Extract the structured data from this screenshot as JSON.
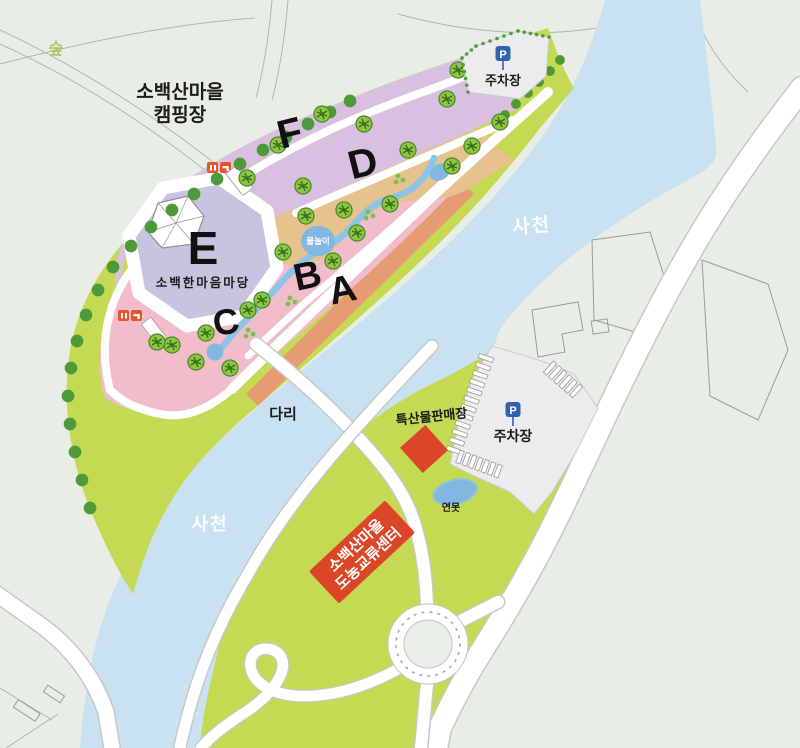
{
  "labels": {
    "forest": "숲",
    "campground_line1": "소백산마을",
    "campground_line2": "캠핑장",
    "river": "사천",
    "bridge": "다리",
    "plaza": "소백한마음마당",
    "water_play": "물놀이",
    "pond": "연못",
    "specialty_shop": "특산물판매장",
    "exchange_center_line1": "소백산마을",
    "exchange_center_line2": "도농교류센터",
    "parking": "주차장",
    "parking_sign": "P"
  },
  "zones": {
    "a": "A",
    "b": "B",
    "c": "C",
    "d": "D",
    "e": "E",
    "f": "F"
  },
  "colors": {
    "background": "#e8eee5",
    "river": "#c9e2f1",
    "grass": "#c3da52",
    "zone-pink": "#f3bccb",
    "zone-lilac": "#d9c0e1",
    "zone-tan": "#e6c28e",
    "zone-lavender": "#c7c4e0",
    "riverbank-orange": "#e79b72",
    "stream": "#8cc3e8",
    "pool": "#82b7e2",
    "tree": "#8ec63f",
    "tree-dark": "#4e9a39",
    "red": "#dd4527",
    "parking-gray": "#ececee",
    "sign-blue": "#2f63ad",
    "road-edge": "#c8c8c8",
    "label-black": "#1c1c1c",
    "river-label": "#ffffff",
    "forest-label": "#a9ca5e"
  }
}
